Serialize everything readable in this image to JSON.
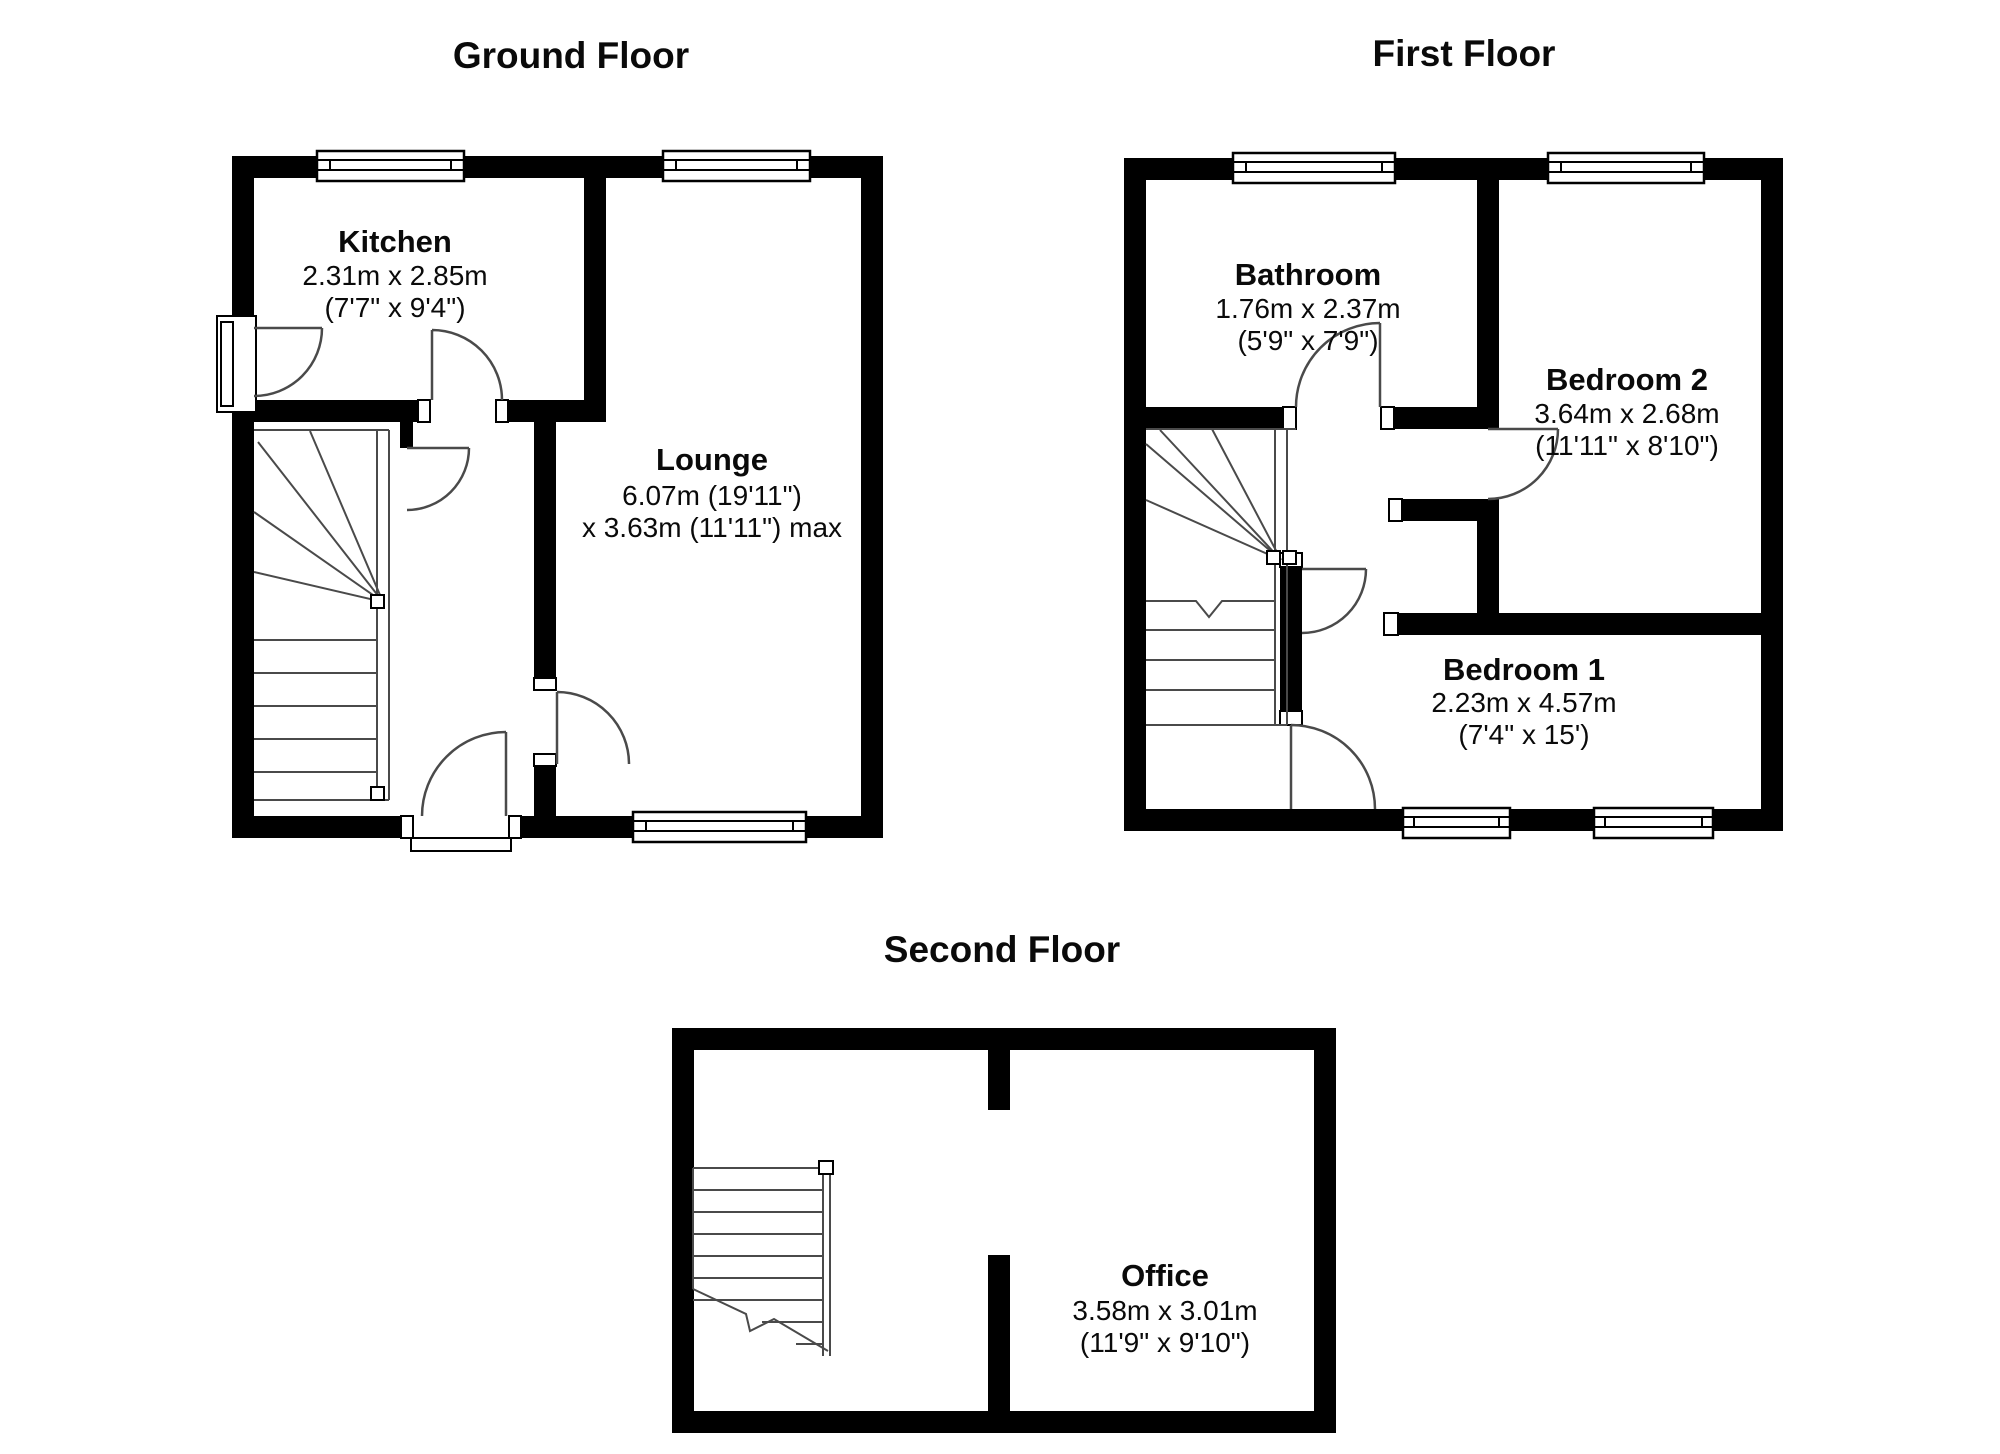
{
  "document": {
    "type": "property-floorplan",
    "background_color": "#ffffff",
    "wall_color": "#000000",
    "text_color": "#0a0a0a"
  },
  "floors": [
    {
      "id": "ground",
      "title": "Ground Floor",
      "rooms": [
        {
          "name": "Kitchen",
          "dim1": "2.31m x 2.85m",
          "dim2": "(7'7\" x 9'4\")"
        },
        {
          "name": "Lounge",
          "dim1": "6.07m (19'11\")",
          "dim2": "x 3.63m (11'11\") max"
        }
      ]
    },
    {
      "id": "first",
      "title": "First Floor",
      "rooms": [
        {
          "name": "Bathroom",
          "dim1": "1.76m x 2.37m",
          "dim2": "(5'9\" x 7'9\")"
        },
        {
          "name": "Bedroom 2",
          "dim1": "3.64m x 2.68m",
          "dim2": "(11'11\" x 8'10\")"
        },
        {
          "name": "Bedroom 1",
          "dim1": "2.23m x 4.57m",
          "dim2": "(7'4\" x 15')"
        }
      ]
    },
    {
      "id": "second",
      "title": "Second Floor",
      "rooms": [
        {
          "name": "Office",
          "dim1": "3.58m x 3.01m",
          "dim2": "(11'9\" x 9'10\")"
        }
      ]
    }
  ]
}
